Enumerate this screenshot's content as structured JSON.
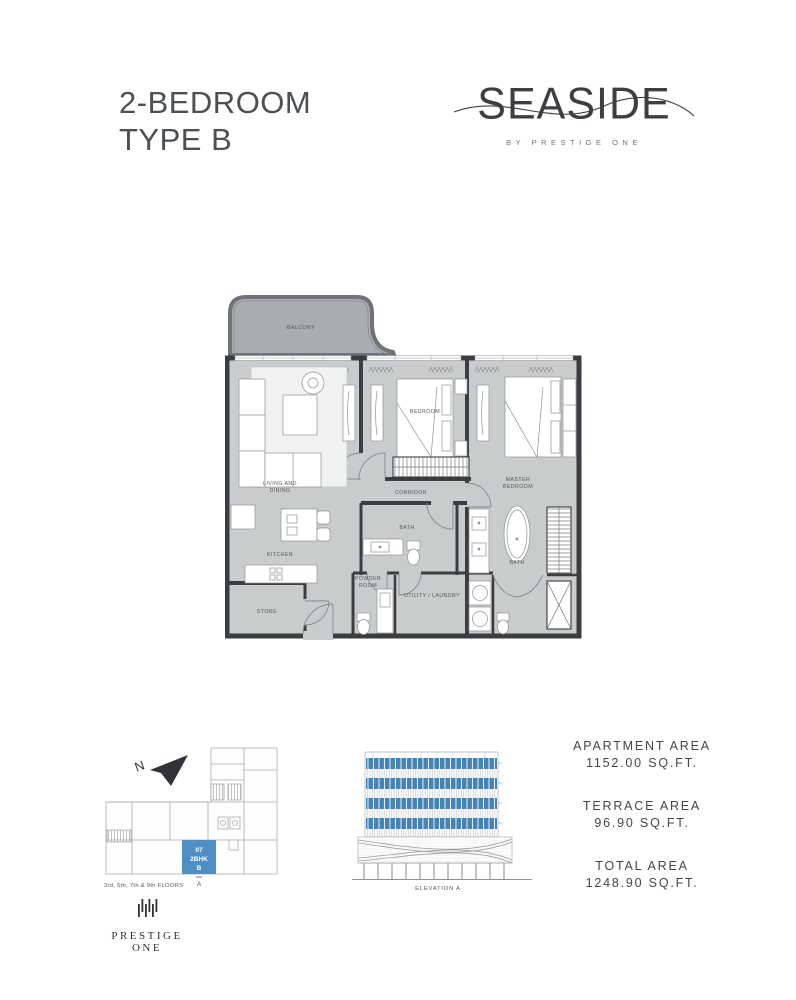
{
  "header": {
    "title_line1": "2-BEDROOM",
    "title_line2": "TYPE B"
  },
  "brand": {
    "wordmark": "SEASIDE",
    "tagline": "BY PRESTIGE ONE"
  },
  "plan": {
    "rooms": {
      "balcony": "BALCONY",
      "living_line1": "LIVING AND",
      "living_line2": "DINING",
      "bedroom": "BEDROOM",
      "corridor": "CORRIDOR",
      "master_line1": "MASTER",
      "master_line2": "BEDROOM",
      "kitchen": "KITCHEN",
      "store": "STORE",
      "bath": "BATH",
      "powder_line1": "POWDER",
      "powder_line2": "ROOM",
      "utility": "UTILITY / LAUNDRY",
      "master_bath": "BATH"
    },
    "colors": {
      "floor": "#c9cccd",
      "balcony": "#a9adb2",
      "wall": "#3a3d41"
    }
  },
  "key_plan": {
    "north": "N",
    "unit": {
      "line1": "07",
      "line2": "2BHK",
      "line3": "B",
      "color": "#4d8fc4"
    },
    "marker": "A",
    "caption": "3rd, 5th, 7th & 9th FLOORS"
  },
  "elevation": {
    "caption": "ELEVATION A",
    "highlight_color": "#4283b8"
  },
  "areas": {
    "items": [
      {
        "label": "APARTMENT AREA",
        "value": "1152.00 SQ.FT."
      },
      {
        "label": "TERRACE AREA",
        "value": "96.90 SQ.FT."
      },
      {
        "label": "TOTAL  AREA",
        "value": "1248.90 SQ.FT."
      }
    ]
  },
  "footer": {
    "brand": "PRESTIGE ONE"
  }
}
